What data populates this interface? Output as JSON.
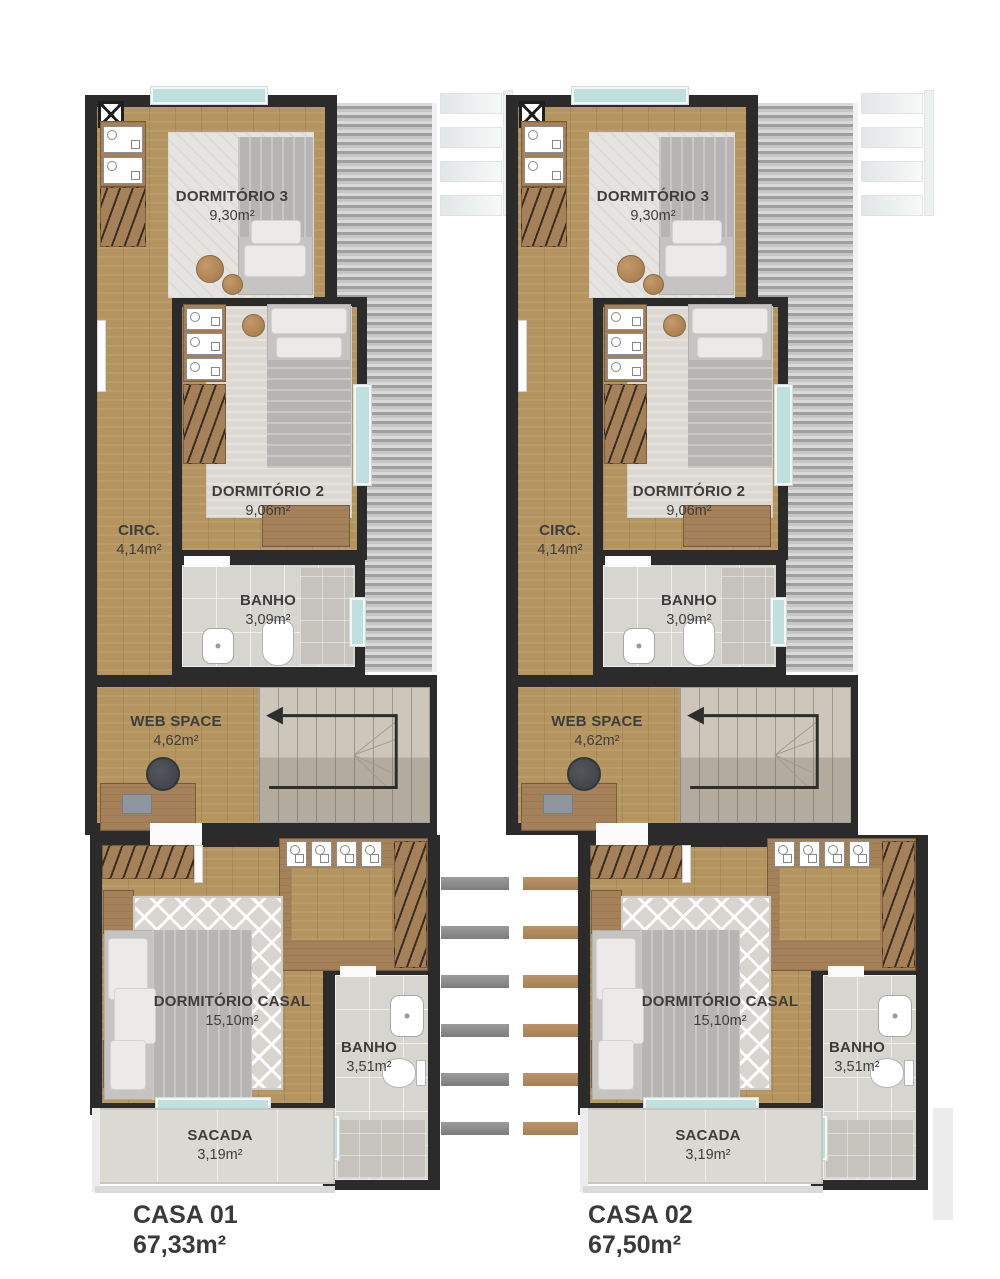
{
  "title": "Planta do pavimento superior - casas geminadas",
  "colors": {
    "background": "#ffffff",
    "wall": "#2b2b2b",
    "wood_floor": "#b4945f",
    "wood_furniture": "#a5815a",
    "roof_dark": "#9f9f9f",
    "roof_light": "#d9d9d9",
    "bath_tile": "#d7d5d0",
    "shower_tile": "#c6c3bd",
    "window_glass": "#bfe0de",
    "stair_concrete": "#cdc6bb",
    "stair_concrete_dark": "#b3ab9e",
    "pergola_gray": "#8c8c8c",
    "pergola_wood": "#b3895f",
    "trellis": "#f1f3f3",
    "text": "#3d3d3d"
  },
  "houses": [
    {
      "id": "casa-01",
      "label": "CASA 01",
      "total_area": "67,33m²",
      "rooms": {
        "dorm3": {
          "name": "DORMITÓRIO 3",
          "area": "9,30m²"
        },
        "dorm2": {
          "name": "DORMITÓRIO 2",
          "area": "9,06m²"
        },
        "circ": {
          "name": "CIRC.",
          "area": "4,14m²"
        },
        "banho_upper": {
          "name": "BANHO",
          "area": "3,09m²"
        },
        "web_space": {
          "name": "WEB SPACE",
          "area": "4,62m²"
        },
        "casal": {
          "name": "DORMITÓRIO CASAL",
          "area": "15,10m²"
        },
        "banho_suite": {
          "name": "BANHO",
          "area": "3,51m²"
        },
        "sacada": {
          "name": "SACADA",
          "area": "3,19m²"
        }
      }
    },
    {
      "id": "casa-02",
      "label": "CASA 02",
      "total_area": "67,50m²",
      "rooms": {
        "dorm3": {
          "name": "DORMITÓRIO 3",
          "area": "9,30m²"
        },
        "dorm2": {
          "name": "DORMITÓRIO 2",
          "area": "9,06m²"
        },
        "circ": {
          "name": "CIRC.",
          "area": "4,14m²"
        },
        "banho_upper": {
          "name": "BANHO",
          "area": "3,09m²"
        },
        "web_space": {
          "name": "WEB SPACE",
          "area": "4,62m²"
        },
        "casal": {
          "name": "DORMITÓRIO CASAL",
          "area": "15,10m²"
        },
        "banho_suite": {
          "name": "BANHO",
          "area": "3,51m²"
        },
        "sacada": {
          "name": "SACADA",
          "area": "3,19m²"
        }
      }
    }
  ],
  "icons": [
    "x-shaft-icon",
    "stair-direction-arrow-icon",
    "toilet-icon",
    "sink-icon",
    "shower-icon",
    "bed-icon",
    "wardrobe-hangers-icon",
    "desk-icon",
    "office-chair-icon",
    "side-table-icon",
    "pergola-bar-icon",
    "trellis-icon"
  ]
}
